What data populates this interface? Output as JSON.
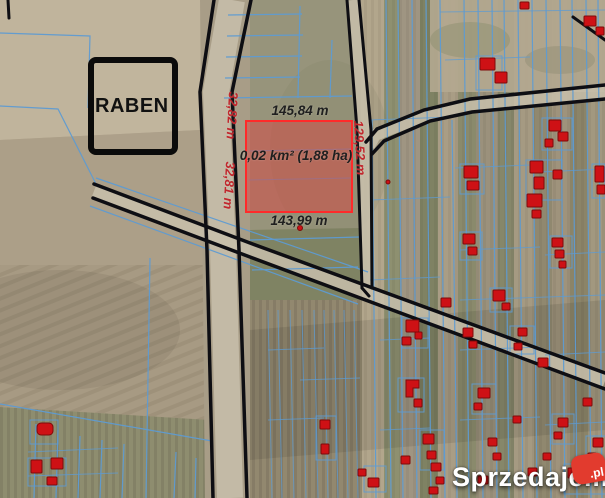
{
  "parcel": {
    "top_length": "145,84 m",
    "area_label": "0,02 km² (1,88 ha)",
    "bottom_length": "143,99 m",
    "left_length_upper": "32,82 m",
    "left_length_lower": "32,81 m",
    "right_length": "129,52 m"
  },
  "landmark": {
    "label": "RABEN"
  },
  "watermark": {
    "text": "Sprzedajemy",
    "tld": ".pl"
  },
  "theme": {
    "cadastral-line": "#5e9bd2",
    "road-line": "#0e0e13",
    "building-fill": "#ce1115",
    "parcel-fill": "#e03c3c",
    "parcel-outline": "#ff2a2a",
    "parcel-label": "#1f1f1f",
    "parcel-side-label": "#c1272d",
    "watermark-logo": "#e23b2e"
  }
}
